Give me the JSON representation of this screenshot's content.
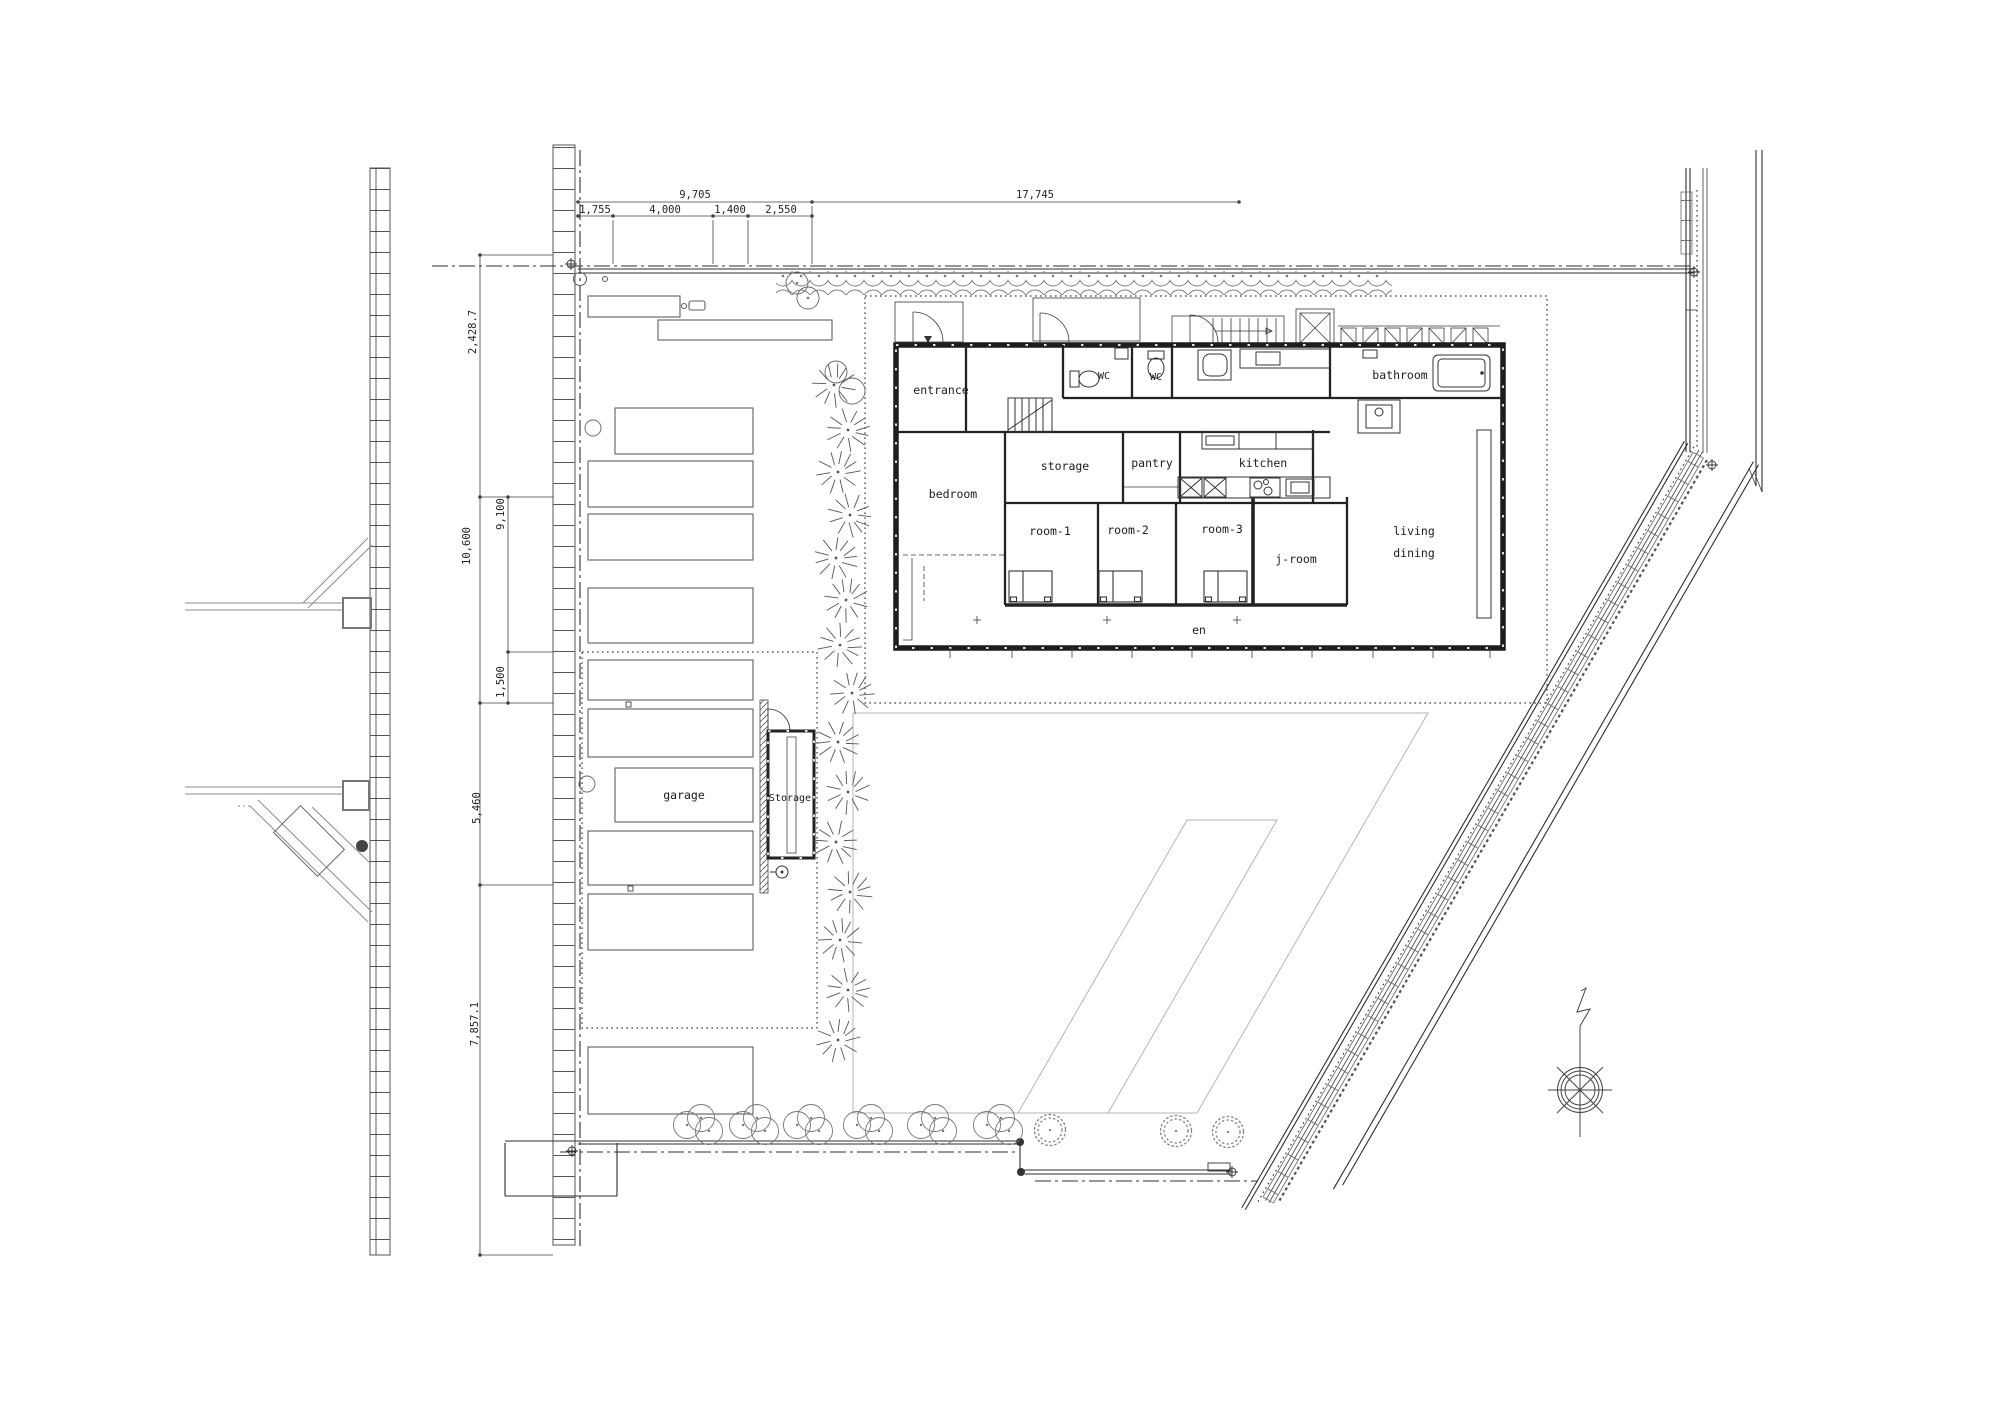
{
  "drawing_type": "site-and-floor-plan",
  "rooms": {
    "entrance": "entrance",
    "wc_left": "WC",
    "wc_right": "WC",
    "bathroom": "bathroom",
    "storage": "storage",
    "pantry": "pantry",
    "kitchen": "kitchen",
    "bedroom": "bedroom",
    "room1": "room-1",
    "room2": "room-2",
    "room3": "room-3",
    "jroom": "j-room",
    "living": "living",
    "dining": "dining",
    "en": "en"
  },
  "site": {
    "garage": "garage",
    "shed": "Storage"
  },
  "dimensions": {
    "top_total_left": "9,705",
    "top_total_right": "17,745",
    "top_segments": [
      "1,755",
      "4,000",
      "1,400",
      "2,550"
    ],
    "left_chain": [
      "2,428.7",
      "10,600",
      "9,100",
      "1,500",
      "5,460",
      "7,857.1"
    ]
  },
  "colors": {
    "line": "#2f2f2f",
    "light_line": "#8c8c8c",
    "background": "#ffffff"
  }
}
